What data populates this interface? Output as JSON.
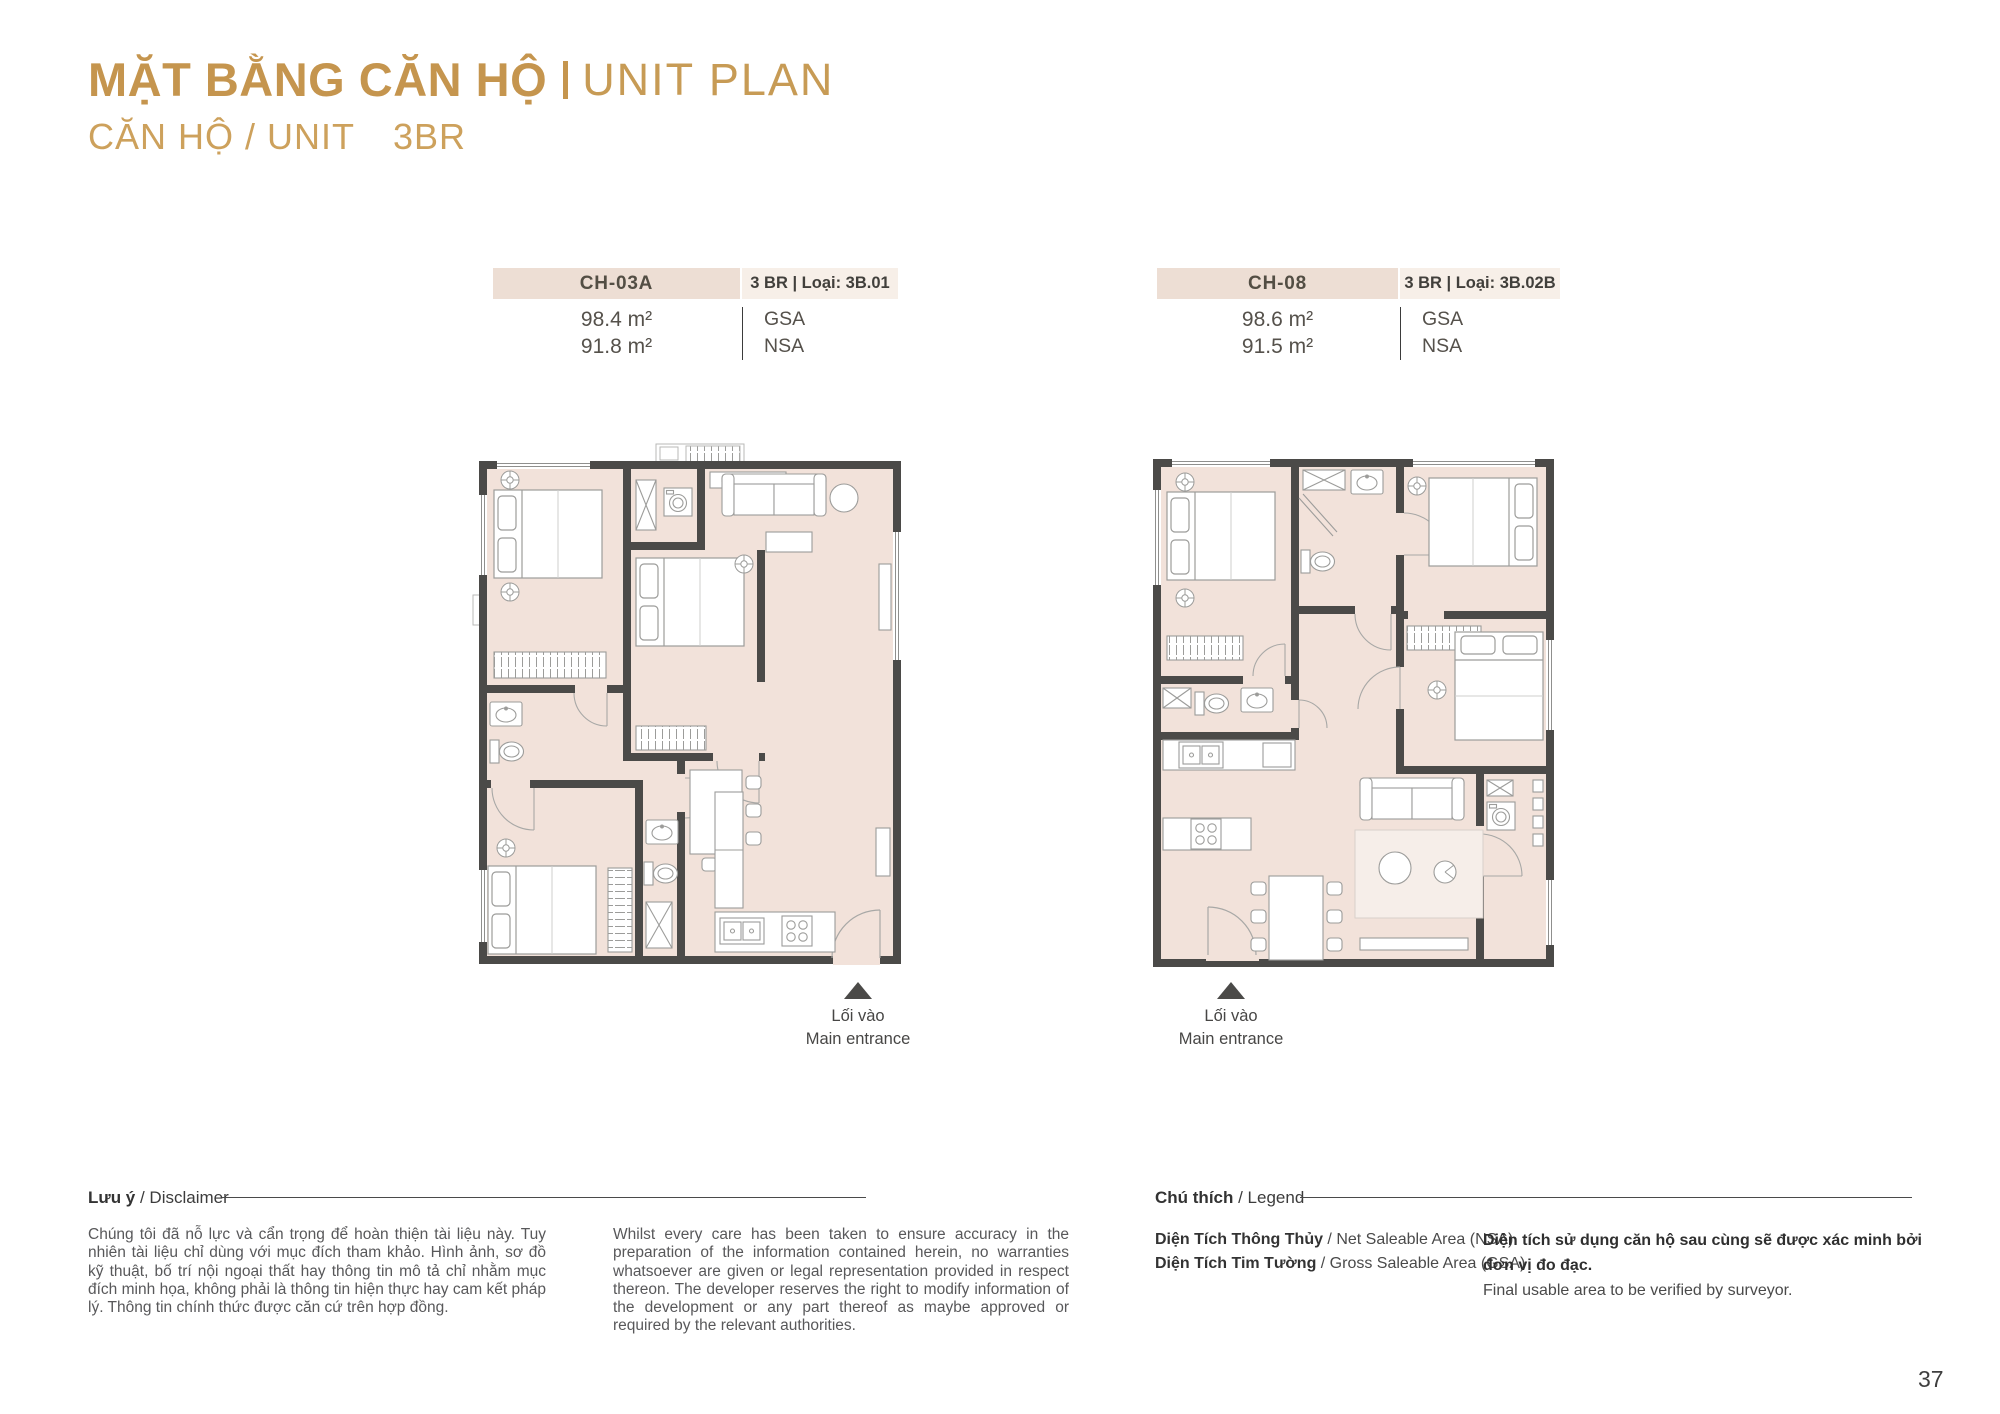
{
  "page": {
    "title_vi": "MẶT BẰNG CĂN HỘ",
    "title_en": "UNIT PLAN",
    "subtitle_vi": "CĂN HỘ / UNIT",
    "subtitle_type": "3BR",
    "page_number": "37"
  },
  "units": [
    {
      "code": "CH-03A",
      "type_label": "3 BR | Loại: 3B.01",
      "gsa_value": "98.4 m²",
      "nsa_value": "91.8 m²",
      "gsa_label": "GSA",
      "nsa_label": "NSA",
      "entrance_vi": "Lối vào",
      "entrance_en": "Main entrance"
    },
    {
      "code": "CH-08",
      "type_label": "3 BR | Loại: 3B.02B",
      "gsa_value": "98.6 m²",
      "nsa_value": "91.5 m²",
      "gsa_label": "GSA",
      "nsa_label": "NSA",
      "entrance_vi": "Lối vào",
      "entrance_en": "Main entrance"
    }
  ],
  "disclaimer": {
    "heading_bold": "Lưu ý",
    "heading_rest": " / Disclaimer",
    "text_vi": "Chúng tôi đã nỗ lực và cẩn trọng để hoàn thiện tài liệu này. Tuy nhiên tài liệu chỉ dùng với mục đích tham khảo. Hình ảnh, sơ đồ kỹ thuật, bố trí nội ngoại thất hay thông tin mô tả chỉ nhằm mục đích minh họa, không phải là thông tin hiện thực hay cam kết pháp lý. Thông tin chính thức được căn cứ trên hợp đồng.",
    "text_en": "Whilst every care has been taken to ensure accuracy in the preparation of the information contained herein, no warranties whatsoever are given or legal representation provided in respect thereon. The developer reserves the right to modify information of the development or any part thereof as maybe approved or required by the relevant authorities."
  },
  "legend": {
    "heading_bold": "Chú thích",
    "heading_rest": " / Legend",
    "rows": [
      {
        "bold": "Diện Tích Thông Thủy",
        "rest": " / Net Saleable Area (NSA)"
      },
      {
        "bold": "Diện Tích Tim Tường",
        "rest": " / Gross Saleable Area (GSA)"
      }
    ],
    "note_bold": "Diện tích sử dụng căn hộ sau cùng sẽ được xác minh bởi đơn vị đo đạc.",
    "note_rest": "Final usable area to be verified by surveyor."
  },
  "colors": {
    "accent_gold": "#C5954E",
    "header_bar_dark": "#EDDED4",
    "header_bar_light": "#F7EFE8",
    "plan_floor": "#F2E2DA",
    "plan_wall": "#4B4A48"
  }
}
